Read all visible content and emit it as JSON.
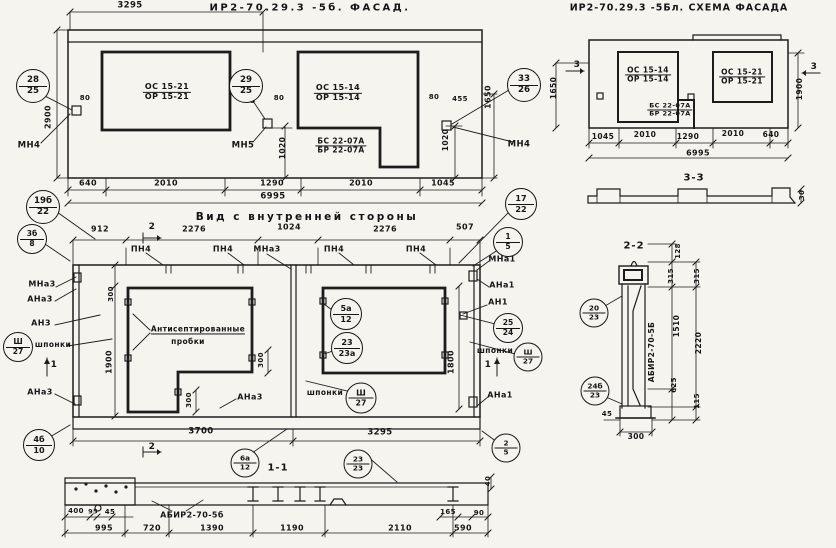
{
  "titles": {
    "facade": "ИР2-70.29.3 -5б. ФАСАД.",
    "schema": "ИР2-70.29.3 -5Бл. СХЕМА ФАСАДА",
    "inner_view": "Вид с внутренней стороны",
    "section_1_1": "1-1",
    "section_2_2": "2-2",
    "section_3_3": "3-3"
  },
  "labels": [
    {
      "name": "facade-dim-3295",
      "text": "3295",
      "x": 130,
      "y": 6,
      "s": 8.5
    },
    {
      "name": "facade-window1-mark",
      "text": "ОС 15-21",
      "text2": "ОР 15-21",
      "x": 167,
      "y": 92,
      "s": 8
    },
    {
      "name": "facade-window2-mark",
      "text": "ОС 15-14",
      "text2": "ОР 15-14",
      "x": 338,
      "y": 93,
      "s": 8
    },
    {
      "name": "facade-door-mark",
      "text": "БС 22-07А",
      "text2": "БР 22-07А",
      "x": 341,
      "y": 146,
      "s": 7.5
    },
    {
      "name": "facade-anchor-mn4-left",
      "text": "МН4",
      "x": 29,
      "y": 146,
      "s": 8.5
    },
    {
      "name": "facade-anchor-mn5",
      "text": "МН5",
      "x": 243,
      "y": 146,
      "s": 8.5
    },
    {
      "name": "facade-anchor-mn4-right",
      "text": "МН4",
      "x": 519,
      "y": 145,
      "s": 8.5
    },
    {
      "name": "facade-dim-80-left",
      "text": "80",
      "x": 85,
      "y": 99,
      "s": 7
    },
    {
      "name": "facade-dim-2900",
      "text": "2900",
      "x": 49,
      "y": 117,
      "s": 8,
      "rot": true
    },
    {
      "name": "facade-dim-5",
      "text": "5",
      "x": 253,
      "y": 102,
      "s": 7
    },
    {
      "name": "facade-dim-80-mid",
      "text": "80",
      "x": 279,
      "y": 99,
      "s": 7
    },
    {
      "name": "facade-dim-80-right",
      "text": "80",
      "x": 434,
      "y": 98,
      "s": 7
    },
    {
      "name": "facade-dim-455",
      "text": "455",
      "x": 460,
      "y": 100,
      "s": 7
    },
    {
      "name": "facade-dim-1650",
      "text": "1650",
      "x": 489,
      "y": 97,
      "s": 8,
      "rot": true
    },
    {
      "name": "facade-dim-1020-mid",
      "text": "1020",
      "x": 283,
      "y": 148,
      "s": 7.5,
      "rot": true
    },
    {
      "name": "facade-dim-1020-right",
      "text": "1020",
      "x": 446,
      "y": 140,
      "s": 7.5,
      "rot": true
    },
    {
      "name": "facade-dim-640",
      "text": "640",
      "x": 88,
      "y": 184,
      "s": 8
    },
    {
      "name": "facade-dim-2010-1",
      "text": "2010",
      "x": 166,
      "y": 184,
      "s": 8
    },
    {
      "name": "facade-dim-1290",
      "text": "1290",
      "x": 272,
      "y": 184,
      "s": 8
    },
    {
      "name": "facade-dim-2010-2",
      "text": "2010",
      "x": 361,
      "y": 184,
      "s": 8
    },
    {
      "name": "facade-dim-1045",
      "text": "1045",
      "x": 443,
      "y": 184,
      "s": 8
    },
    {
      "name": "facade-dim-6995",
      "text": "6995",
      "x": 273,
      "y": 197,
      "s": 8.5
    },
    {
      "name": "schema-window1-mark",
      "text": "ОС 15-14",
      "text2": "ОР 15-14",
      "x": 648,
      "y": 75,
      "s": 7.5
    },
    {
      "name": "schema-door-mark",
      "text": "БС 22-07А",
      "text2": "БР 22-07А",
      "x": 670,
      "y": 110,
      "s": 6.5
    },
    {
      "name": "schema-window2-mark",
      "text": "ОС 15-21",
      "text2": "ОР 15-21",
      "x": 742,
      "y": 77,
      "s": 7.5
    },
    {
      "name": "schema-section3-left",
      "text": "3",
      "x": 577,
      "y": 66,
      "s": 9
    },
    {
      "name": "schema-section3-right",
      "text": "3",
      "x": 814,
      "y": 68,
      "s": 9
    },
    {
      "name": "schema-dim-1650",
      "text": "1650",
      "x": 554,
      "y": 88,
      "s": 7.5,
      "rot": true
    },
    {
      "name": "schema-dim-1900",
      "text": "1900",
      "x": 800,
      "y": 89,
      "s": 7.5,
      "rot": true
    },
    {
      "name": "schema-dim-1045",
      "text": "1045",
      "x": 603,
      "y": 137,
      "s": 7.5
    },
    {
      "name": "schema-dim-2010-1",
      "text": "2010",
      "x": 645,
      "y": 135,
      "s": 7.5
    },
    {
      "name": "schema-dim-1290",
      "text": "1290",
      "x": 688,
      "y": 137,
      "s": 7.5
    },
    {
      "name": "schema-dim-2010-2",
      "text": "2010",
      "x": 733,
      "y": 134,
      "s": 7.5
    },
    {
      "name": "schema-dim-640",
      "text": "640",
      "x": 771,
      "y": 135,
      "s": 7.5
    },
    {
      "name": "schema-dim-6995",
      "text": "6995",
      "x": 698,
      "y": 154,
      "s": 8
    },
    {
      "name": "section33-dim-30",
      "text": "30",
      "x": 803,
      "y": 195,
      "s": 7,
      "rot": true
    },
    {
      "name": "section22-panel-mark",
      "text": "АБИР2-70-5Б",
      "x": 652,
      "y": 352,
      "s": 7.5,
      "rot": true
    },
    {
      "name": "section22-dim-128",
      "text": "128",
      "x": 679,
      "y": 251,
      "s": 7,
      "rot": true
    },
    {
      "name": "section22-dim-315-a",
      "text": "315",
      "x": 672,
      "y": 276,
      "s": 7,
      "rot": true
    },
    {
      "name": "section22-dim-315-b",
      "text": "315",
      "x": 698,
      "y": 276,
      "s": 7,
      "rot": true
    },
    {
      "name": "section22-dim-1510",
      "text": "1510",
      "x": 677,
      "y": 326,
      "s": 7.5,
      "rot": true
    },
    {
      "name": "section22-dim-2220",
      "text": "2220",
      "x": 699,
      "y": 343,
      "s": 7.5,
      "rot": true
    },
    {
      "name": "section22-dim-625",
      "text": "625",
      "x": 675,
      "y": 385,
      "s": 7,
      "rot": true
    },
    {
      "name": "section22-dim-115",
      "text": "115",
      "x": 698,
      "y": 401,
      "s": 7,
      "rot": true
    },
    {
      "name": "section22-dim-45",
      "text": "45",
      "x": 607,
      "y": 415,
      "s": 7
    },
    {
      "name": "section22-dim-300",
      "text": "300",
      "x": 636,
      "y": 437,
      "s": 7.5
    },
    {
      "name": "inner-dim-912",
      "text": "912",
      "x": 100,
      "y": 230,
      "s": 8
    },
    {
      "name": "inner-section2-top",
      "text": "2",
      "x": 152,
      "y": 228,
      "s": 9
    },
    {
      "name": "inner-dim-2276-a",
      "text": "2276",
      "x": 194,
      "y": 230,
      "s": 8
    },
    {
      "name": "inner-dim-1024",
      "text": "1024",
      "x": 289,
      "y": 228,
      "s": 8
    },
    {
      "name": "inner-dim-2276-b",
      "text": "2276",
      "x": 385,
      "y": 230,
      "s": 8
    },
    {
      "name": "inner-dim-507",
      "text": "507",
      "x": 465,
      "y": 228,
      "s": 8
    },
    {
      "name": "inner-rib-pn4-1",
      "text": "ПН4",
      "x": 141,
      "y": 250,
      "s": 8
    },
    {
      "name": "inner-rib-pn4-2",
      "text": "ПН4",
      "x": 223,
      "y": 250,
      "s": 8
    },
    {
      "name": "inner-rib-mna3",
      "text": "МНа3",
      "x": 267,
      "y": 250,
      "s": 8
    },
    {
      "name": "inner-rib-pn4-3",
      "text": "ПН4",
      "x": 334,
      "y": 250,
      "s": 8
    },
    {
      "name": "inner-rib-pn4-4",
      "text": "ПН4",
      "x": 416,
      "y": 250,
      "s": 8
    },
    {
      "name": "inner-left-mna3",
      "text": "МНа3",
      "x": 42,
      "y": 285,
      "s": 8
    },
    {
      "name": "inner-left-ana3-1",
      "text": "АНа3",
      "x": 40,
      "y": 300,
      "s": 8
    },
    {
      "name": "inner-left-an3",
      "text": "АН3",
      "x": 41,
      "y": 324,
      "s": 8
    },
    {
      "name": "inner-left-shponki",
      "text": "шпонки",
      "x": 53,
      "y": 345,
      "s": 7.5
    },
    {
      "name": "inner-section1-left",
      "text": "1",
      "x": 54,
      "y": 366,
      "s": 9
    },
    {
      "name": "inner-left-ana3-2",
      "text": "АНа3",
      "x": 40,
      "y": 393,
      "s": 8
    },
    {
      "name": "inner-right-mna1",
      "text": "МНа1",
      "x": 502,
      "y": 260,
      "s": 8
    },
    {
      "name": "inner-right-ana1-1",
      "text": "АНа1",
      "x": 502,
      "y": 286,
      "s": 8
    },
    {
      "name": "inner-right-an1",
      "text": "АН1",
      "x": 498,
      "y": 303,
      "s": 8
    },
    {
      "name": "inner-right-shponki",
      "text": "шпонки",
      "x": 495,
      "y": 351,
      "s": 7.5
    },
    {
      "name": "inner-section1-right",
      "text": "1",
      "x": 488,
      "y": 366,
      "s": 9
    },
    {
      "name": "inner-right-ana1-2",
      "text": "АНа1",
      "x": 500,
      "y": 396,
      "s": 8
    },
    {
      "name": "inner-note-antiseptic",
      "text": "Антисептированные",
      "x": 198,
      "y": 330,
      "s": 7.5,
      "ul": true
    },
    {
      "name": "inner-note-probki",
      "text": "пробки",
      "x": 188,
      "y": 342,
      "s": 7.5
    },
    {
      "name": "inner-dim-300-left",
      "text": "300",
      "x": 112,
      "y": 294,
      "s": 7,
      "rot": true
    },
    {
      "name": "inner-dim-1900",
      "text": "1900",
      "x": 110,
      "y": 362,
      "s": 8,
      "rot": true
    },
    {
      "name": "inner-dim-300-mid",
      "text": "300",
      "x": 262,
      "y": 360,
      "s": 7,
      "rot": true
    },
    {
      "name": "inner-dim-300-notch",
      "text": "300",
      "x": 190,
      "y": 400,
      "s": 7,
      "rot": true
    },
    {
      "name": "inner-dim-1800",
      "text": "1800",
      "x": 452,
      "y": 362,
      "s": 8,
      "rot": true
    },
    {
      "name": "inner-mid-shponki",
      "text": "шпонки",
      "x": 325,
      "y": 393,
      "s": 7.5
    },
    {
      "name": "inner-mid-ana3",
      "text": "АНа3",
      "x": 250,
      "y": 398,
      "s": 8
    },
    {
      "name": "inner-dim-3700",
      "text": "3700",
      "x": 201,
      "y": 432,
      "s": 8.5
    },
    {
      "name": "inner-dim-3295",
      "text": "3295",
      "x": 380,
      "y": 433,
      "s": 8.5
    },
    {
      "name": "inner-section2-bottom",
      "text": "2",
      "x": 152,
      "y": 448,
      "s": 9
    },
    {
      "name": "section11-panel-mark",
      "text": "АБИР2-70-5б",
      "x": 192,
      "y": 516,
      "s": 8
    },
    {
      "name": "section11-dim-400",
      "text": "400",
      "x": 76,
      "y": 512,
      "s": 7
    },
    {
      "name": "section11-dim-95",
      "text": "95",
      "x": 93,
      "y": 512,
      "s": 6.5
    },
    {
      "name": "section11-dim-45",
      "text": "45",
      "x": 110,
      "y": 513,
      "s": 7
    },
    {
      "name": "section11-dim-995",
      "text": "995",
      "x": 104,
      "y": 529,
      "s": 8
    },
    {
      "name": "section11-dim-720",
      "text": "720",
      "x": 152,
      "y": 529,
      "s": 8
    },
    {
      "name": "section11-dim-1390",
      "text": "1390",
      "x": 212,
      "y": 529,
      "s": 8
    },
    {
      "name": "section11-dim-1190",
      "text": "1190",
      "x": 292,
      "y": 529,
      "s": 8
    },
    {
      "name": "section11-dim-2110",
      "text": "2110",
      "x": 400,
      "y": 529,
      "s": 8
    },
    {
      "name": "section11-dim-590",
      "text": "590",
      "x": 463,
      "y": 529,
      "s": 8
    },
    {
      "name": "section11-dim-165",
      "text": "165",
      "x": 448,
      "y": 513,
      "s": 7
    },
    {
      "name": "section11-dim-90",
      "text": "90",
      "x": 479,
      "y": 514,
      "s": 7
    },
    {
      "name": "section11-dim-40",
      "text": "40",
      "x": 489,
      "y": 481,
      "s": 7,
      "rot": true
    }
  ],
  "callouts": [
    {
      "name": "callout-28-25",
      "top": "28",
      "bottom": "25",
      "x": 33,
      "y": 86,
      "d": 32
    },
    {
      "name": "callout-29-25",
      "top": "29",
      "bottom": "25",
      "x": 246,
      "y": 86,
      "d": 32
    },
    {
      "name": "callout-33-26",
      "top": "33",
      "bottom": "26",
      "x": 524,
      "y": 85,
      "d": 32
    },
    {
      "name": "callout-19b-22",
      "top": "19б",
      "bottom": "22",
      "x": 43,
      "y": 207,
      "d": 32
    },
    {
      "name": "callout-3b-8",
      "top": "3б",
      "bottom": "8",
      "x": 32,
      "y": 239,
      "d": 28
    },
    {
      "name": "callout-17-22",
      "top": "17",
      "bottom": "22",
      "x": 521,
      "y": 204,
      "d": 30
    },
    {
      "name": "callout-1-5",
      "top": "1",
      "bottom": "5",
      "x": 508,
      "y": 242,
      "d": 28
    },
    {
      "name": "callout-5a-12",
      "top": "5а",
      "bottom": "12",
      "x": 346,
      "y": 314,
      "d": 30
    },
    {
      "name": "callout-23-23a",
      "top": "23",
      "bottom": "23а",
      "x": 347,
      "y": 348,
      "d": 30
    },
    {
      "name": "callout-sh-27-left",
      "top": "Ш",
      "bottom": "27",
      "x": 18,
      "y": 347,
      "d": 28
    },
    {
      "name": "callout-25-24",
      "top": "25",
      "bottom": "24",
      "x": 508,
      "y": 328,
      "d": 28
    },
    {
      "name": "callout-sh-27-right",
      "top": "Ш",
      "bottom": "27",
      "x": 528,
      "y": 357,
      "d": 27
    },
    {
      "name": "callout-sh-27-mid",
      "top": "Ш",
      "bottom": "27",
      "x": 361,
      "y": 398,
      "d": 29
    },
    {
      "name": "callout-4b-10",
      "top": "4б",
      "bottom": "10",
      "x": 39,
      "y": 445,
      "d": 30
    },
    {
      "name": "callout-2-5",
      "top": "2",
      "bottom": "5",
      "x": 506,
      "y": 448,
      "d": 27
    },
    {
      "name": "callout-6a-12",
      "top": "6а",
      "bottom": "12",
      "x": 245,
      "y": 463,
      "d": 27
    },
    {
      "name": "callout-23-23",
      "top": "23",
      "bottom": "23",
      "x": 358,
      "y": 464,
      "d": 27
    },
    {
      "name": "callout-20-23",
      "top": "20",
      "bottom": "23",
      "x": 594,
      "y": 313,
      "d": 27
    },
    {
      "name": "callout-24b-23",
      "top": "24б",
      "bottom": "23",
      "x": 595,
      "y": 391,
      "d": 27
    }
  ]
}
